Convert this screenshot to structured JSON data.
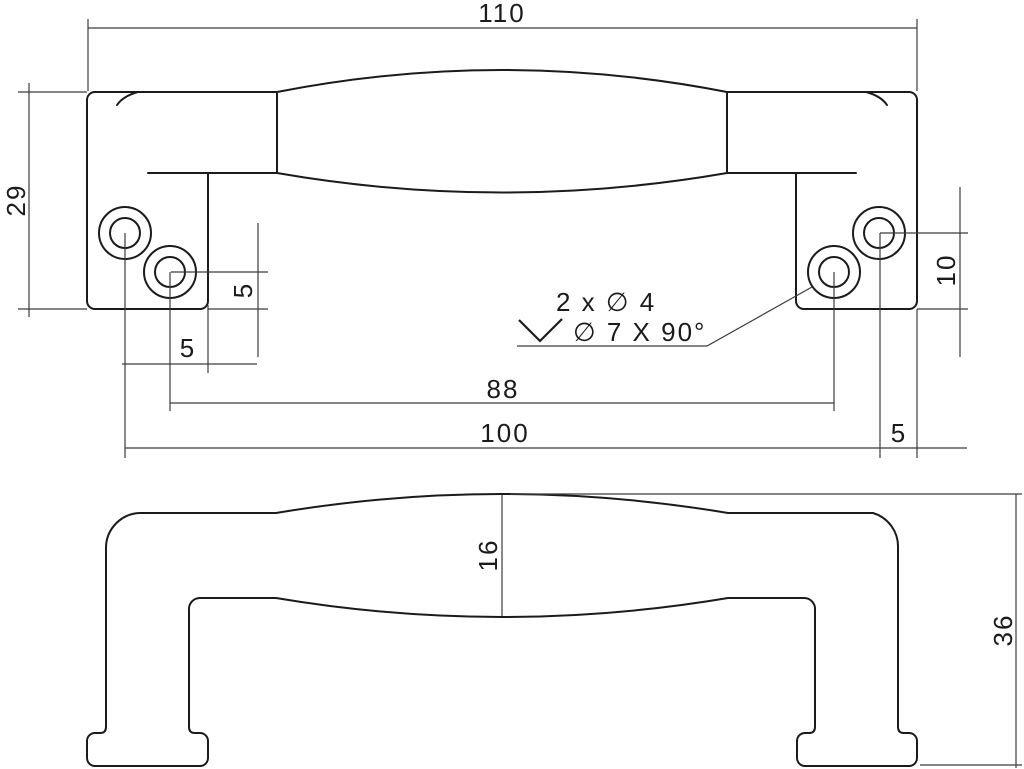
{
  "top_view": {
    "dims": {
      "overall_length": "110",
      "cap_depth": "29",
      "hole_to_edge_vertical": "5",
      "hole_to_edge_horizontal": "5",
      "inner_hole_spacing": "88",
      "outer_hole_spacing": "100",
      "hole_bottom_offset": "10",
      "hole_right_edge_offset": "5"
    },
    "note": {
      "line1": "2 x ∅ 4",
      "line2": "∅ 7 X 90°"
    }
  },
  "side_view": {
    "dims": {
      "grip_height": "16",
      "overall_height": "36"
    }
  }
}
